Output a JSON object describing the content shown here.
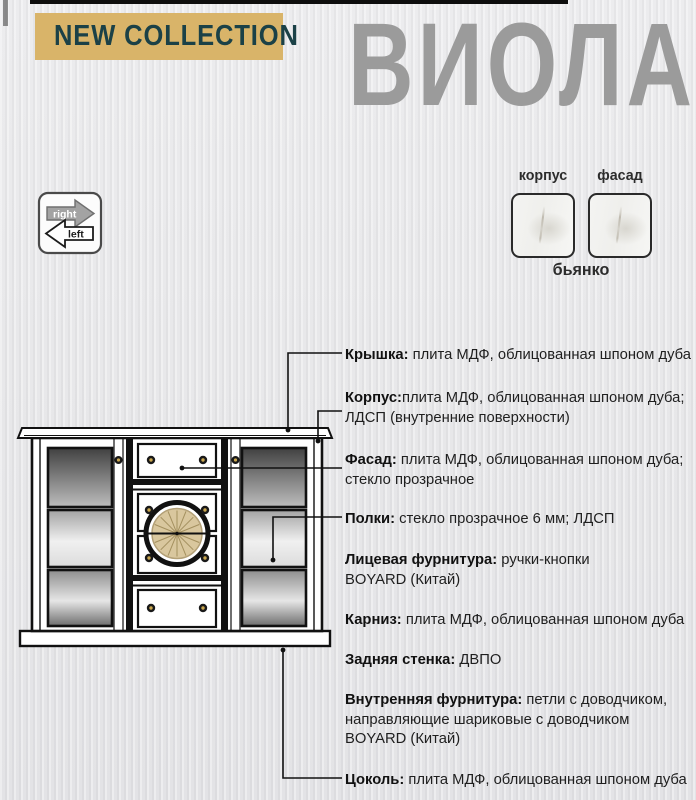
{
  "header": {
    "badge": "NEW COLLECTION",
    "title": "ВИОЛА"
  },
  "orientation_icon": {
    "right_label": "right",
    "left_label": "left"
  },
  "finishes": {
    "swatch_labels": [
      "корпус",
      "фасад"
    ],
    "finish_name": "бьянко"
  },
  "specs": [
    {
      "label": "Крышка:",
      "line1": " плита МДФ, облицованная шпоном дуба",
      "line2": "",
      "line3": ""
    },
    {
      "label": "Корпус:",
      "line1": "плита МДФ, облицованная шпоном дуба;",
      "line2": "ЛДСП (внутренние поверхности)",
      "line3": ""
    },
    {
      "label": "Фасад:",
      "line1": " плита МДФ, облицованная шпоном дуба;",
      "line2": "стекло прозрачное",
      "line3": ""
    },
    {
      "label": "Полки:",
      "line1": " стекло прозрачное 6 мм; ЛДСП",
      "line2": "",
      "line3": ""
    },
    {
      "label": "Лицевая фурнитура:",
      "line1": " ручки-кнопки",
      "line2": "BOYARD (Китай)",
      "line3": ""
    },
    {
      "label": "Карниз:",
      "line1": " плита МДФ, облицованная шпоном дуба",
      "line2": "",
      "line3": ""
    },
    {
      "label": "Задняя стенка:",
      "line1": " ДВПО",
      "line2": "",
      "line3": ""
    },
    {
      "label": "Внутренняя фурнитура:",
      "line1": " петли с доводчиком,",
      "line2": "направляющие шариковые  с доводчиком",
      "line3": "BOYARD (Китай)"
    },
    {
      "label": "Цоколь:",
      "line1": " плита МДФ, облицованная шпоном дуба",
      "line2": "",
      "line3": ""
    }
  ],
  "colors": {
    "badge_bg": "#d9b469",
    "badge_text": "#1b4147",
    "title_gray": "#9b9b9b",
    "body_text": "#1f1f1f",
    "line_black": "#111111",
    "medallion_beige": "#d9c79e",
    "knob_gold": "#c9a64e"
  }
}
